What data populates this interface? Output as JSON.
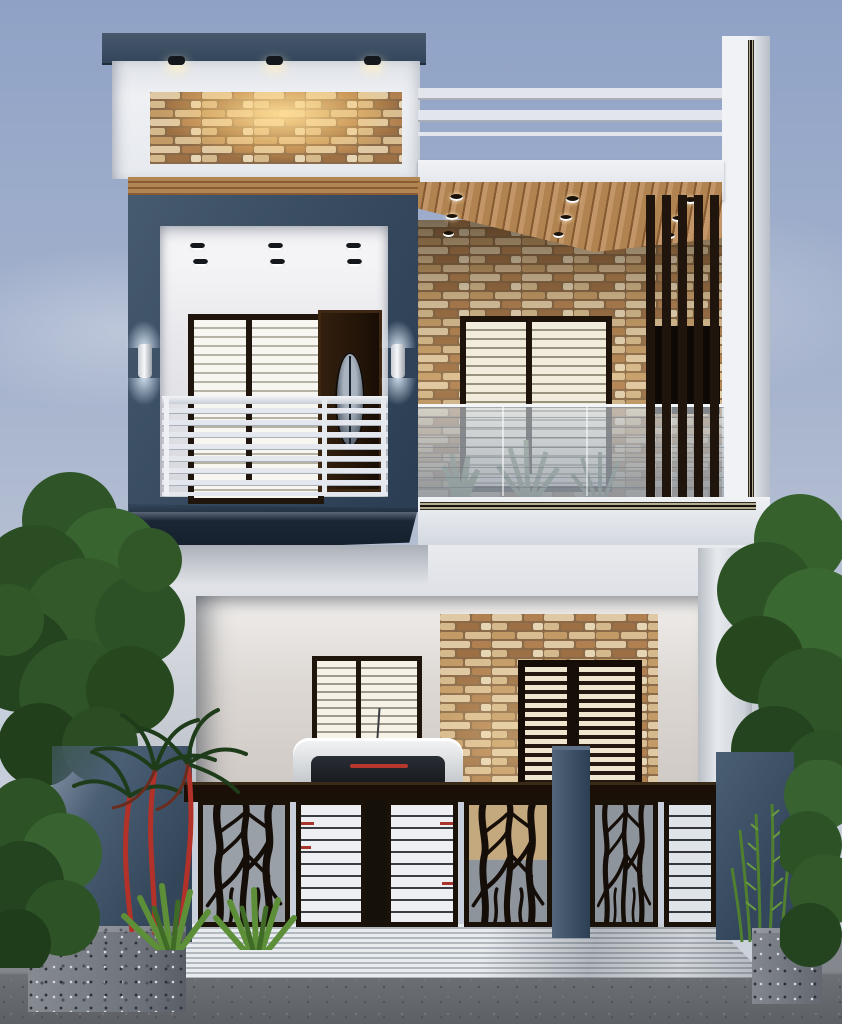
{
  "scene": {
    "type": "architectural-render",
    "title": "Modern two-storey duplex house exterior at dusk",
    "time_of_day": "dusk",
    "floors": 2
  },
  "palette": {
    "sky1": "#8fa2c6",
    "sky2": "#c7cedb",
    "white": "#e9ebef",
    "whiteD": "#c6cad2",
    "slate": "#3d5065",
    "slateD": "#22303f",
    "wood": "#a87c4c",
    "woodD": "#6f4a28",
    "frame": "#20150c",
    "glow": "#ffd99c",
    "glass": "#aeb7c2",
    "rail": "#e3e7ed",
    "gateD": "#170e07",
    "gateW": "#e8eaee",
    "red": "#ad352b",
    "leaf": "#33592a",
    "leafD": "#203d1b",
    "granite": "#75797f",
    "road": "#63666b",
    "stepL": "#e7eaed",
    "stepD": "#b4bac1",
    "stone1": "#dfc9a4",
    "stone2": "#b08050",
    "stone3": "#8a6244"
  },
  "elements": {
    "roof_parapet": {
      "cap": "slate blue cap",
      "accent": "backlit ledgestone panel",
      "downlights": 3,
      "terrace_railing_bars": 3
    },
    "upper_left_balcony": {
      "frame": "slate blue projecting box",
      "ceiling_downlights": 6,
      "window_panes": 2,
      "door": "dark wood door with oval glass",
      "railing": "white horizontal bars",
      "wall_sconces": 2
    },
    "upper_right_balcony": {
      "ceiling": "wood plank soffit",
      "ceiling_downlights": 9,
      "wall": "ledgestone veneer",
      "window_panes": 2,
      "screen": "vertical wood slat screen",
      "railing": "frosted glass with cables",
      "plants": "agaves behind glass"
    },
    "ground_floor": {
      "porch": "open car porch",
      "window_panes": 2,
      "entry": "double louvered wood door on stone wall",
      "vehicle": "white SUV, rear view"
    },
    "gate": {
      "style": "laser-cut branch panels alternating with white slat panels",
      "branch_panels": 3,
      "white_panels": 3,
      "pillar": "slate blue gate pillar",
      "accents": "red slat marks"
    },
    "landscape": {
      "trees": 2,
      "shrubs": 2,
      "red_stem_palm": 1,
      "ferns": 1,
      "granite_planters": 2,
      "approach": "striped concrete ramp",
      "road": "asphalt"
    }
  }
}
